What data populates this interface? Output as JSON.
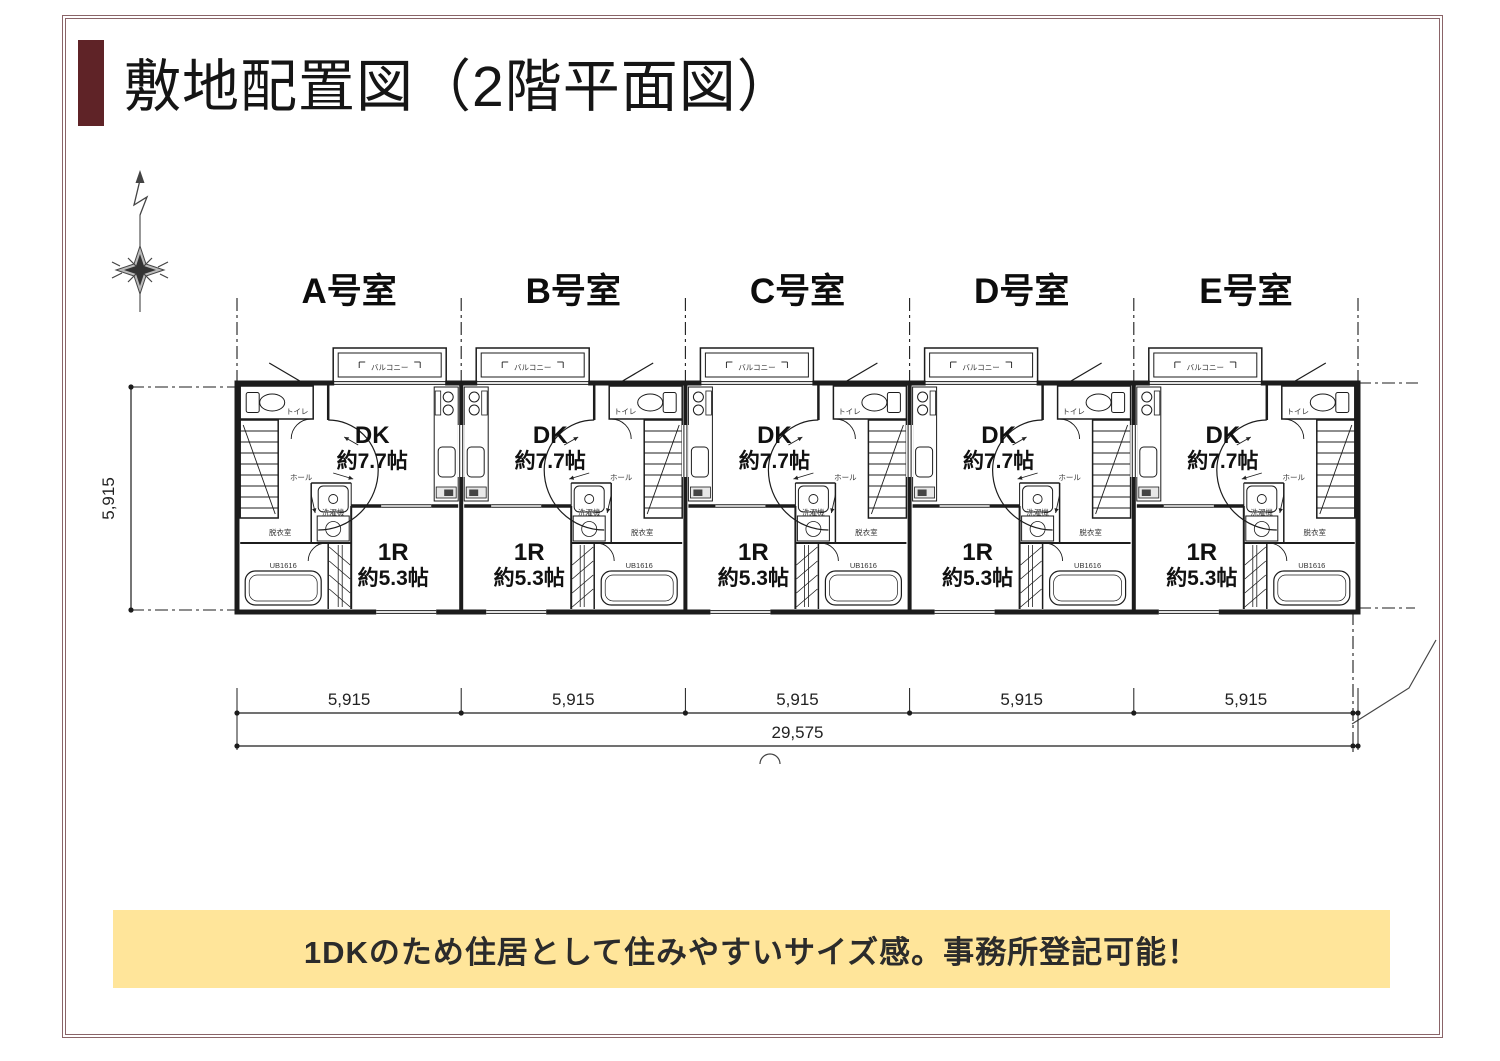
{
  "colors": {
    "accent": "#5F2327",
    "frame": "#8A6468",
    "banner_bg": "#FFE59A",
    "banner_text": "#2B2B2B",
    "ink": "#1C1C1C"
  },
  "header": {
    "title": "敷地配置図（2階平面図）"
  },
  "plan": {
    "units": [
      {
        "id": "A",
        "label": "A号室",
        "mirrored": true
      },
      {
        "id": "B",
        "label": "B号室",
        "mirrored": false
      },
      {
        "id": "C",
        "label": "C号室",
        "mirrored": false
      },
      {
        "id": "D",
        "label": "D号室",
        "mirrored": false
      },
      {
        "id": "E",
        "label": "E号室",
        "mirrored": false
      }
    ],
    "room_texts": {
      "dk_label": "DK",
      "dk_area": "約7.7帖",
      "main_label": "1R",
      "main_area": "約5.3帖",
      "balcony": "バルコニー",
      "hall": "ホール",
      "dressing_room": "脱衣室",
      "toilet": "トイレ",
      "washer": "洗濯機",
      "bath_unit": "UB1616"
    },
    "dimensions": {
      "depth": "5,915",
      "unit_widths": [
        "5,915",
        "5,915",
        "5,915",
        "5,915",
        "5,915"
      ],
      "total_width": "29,575"
    }
  },
  "banner": {
    "text": "1DKのため住居として住みやすいサイズ感。事務所登記可能！"
  }
}
